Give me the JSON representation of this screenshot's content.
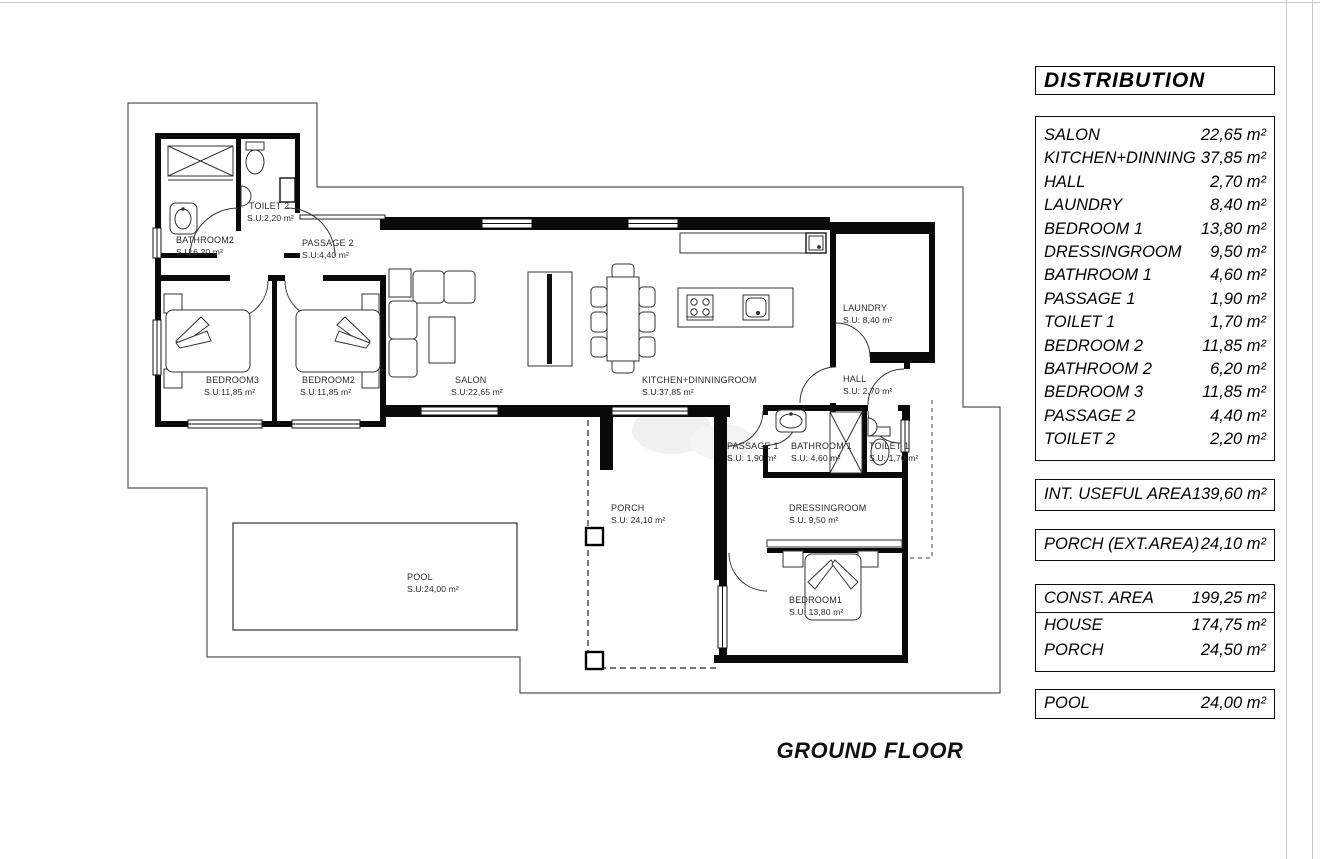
{
  "title": "GROUND FLOOR",
  "panel": {
    "header": "DISTRIBUTION",
    "rooms": [
      {
        "name": "SALON",
        "area": "22,65 m²"
      },
      {
        "name": "KITCHEN+DINNING",
        "area": "37,85 m²"
      },
      {
        "name": "HALL",
        "area": "2,70 m²"
      },
      {
        "name": "LAUNDRY",
        "area": "8,40 m²"
      },
      {
        "name": "BEDROOM 1",
        "area": "13,80 m²"
      },
      {
        "name": "DRESSINGROOM",
        "area": "9,50 m²"
      },
      {
        "name": "BATHROOM 1",
        "area": "4,60 m²"
      },
      {
        "name": "PASSAGE 1",
        "area": "1,90 m²"
      },
      {
        "name": "TOILET 1",
        "area": "1,70 m²"
      },
      {
        "name": "BEDROOM 2",
        "area": "11,85 m²"
      },
      {
        "name": "BATHROOM 2",
        "area": "6,20 m²"
      },
      {
        "name": "BEDROOM 3",
        "area": "11,85 m²"
      },
      {
        "name": "PASSAGE 2",
        "area": "4,40 m²"
      },
      {
        "name": "TOILET 2",
        "area": "2,20 m²"
      }
    ],
    "int_useful": {
      "label": "INT. USEFUL AREA",
      "area": "139,60 m²"
    },
    "porch_ext": {
      "label": "PORCH (EXT.AREA)",
      "area": "24,10 m²"
    },
    "construction": {
      "label": "CONST. AREA",
      "area": "199,25 m²",
      "sub": [
        {
          "label": "HOUSE",
          "area": "174,75 m²"
        },
        {
          "label": "PORCH",
          "area": "24,50 m²"
        }
      ]
    },
    "pool": {
      "label": "POOL",
      "area": "24,00 m²"
    }
  },
  "plan": {
    "rooms": [
      {
        "name": "BATHROOM2",
        "area": "S.U:6,20 m²"
      },
      {
        "name": "TOILET 2",
        "area": "S.U:2,20 m²"
      },
      {
        "name": "PASSAGE 2",
        "area": "S.U:4,40 m²"
      },
      {
        "name": "BEDROOM3",
        "area": "S.U:11,85 m²"
      },
      {
        "name": "BEDROOM2",
        "area": "S.U:11,85 m²"
      },
      {
        "name": "SALON",
        "area": "S.U:22,65 m²"
      },
      {
        "name": "KITCHEN+DINNINGROOM",
        "area": "S.U:37,85 m²"
      },
      {
        "name": "LAUNDRY",
        "area": "S.U: 8,40 m²"
      },
      {
        "name": "HALL",
        "area": "S.U: 2,70 m²"
      },
      {
        "name": "PASSAGE 1",
        "area": "S.U: 1,90 m²"
      },
      {
        "name": "BATHROOM 1",
        "area": "S.U: 4,60 m²"
      },
      {
        "name": "TOILET 1",
        "area": "S.U: 1,70 m²"
      },
      {
        "name": "DRESSINGROOM",
        "area": "S.U: 9,50 m²"
      },
      {
        "name": "BEDROOM1",
        "area": "S.U: 13,80 m²"
      },
      {
        "name": "PORCH",
        "area": "S.U: 24,10 m²"
      },
      {
        "name": "POOL",
        "area": "S.U:24,00 m²"
      }
    ]
  }
}
